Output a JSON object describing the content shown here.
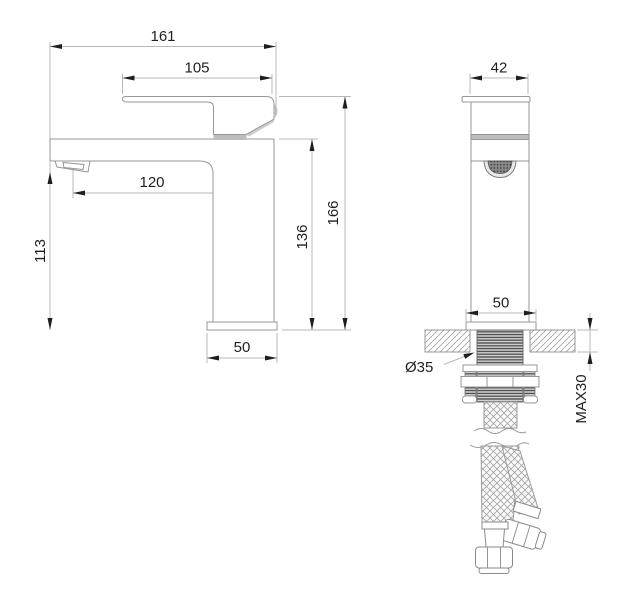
{
  "drawing": {
    "kind": "faucet-installation-dimension-drawing",
    "units_note": "",
    "colors": {
      "background": "#ffffff",
      "object_line": "#979797",
      "dimension_line": "#b8b8b8",
      "text": "#1f1f1f",
      "shading": "#bdbdbd"
    }
  },
  "side_view": {
    "dims": {
      "total_length": "161",
      "handle_length": "105",
      "spout_reach": "120",
      "outlet_height": "113",
      "body_height": "136",
      "overall_height": "166",
      "base_depth": "50"
    }
  },
  "front_view": {
    "dims": {
      "body_width": "42",
      "base_width": "50",
      "shank_diameter": "Ø35",
      "max_mounting_thickness": "MAX30"
    }
  }
}
